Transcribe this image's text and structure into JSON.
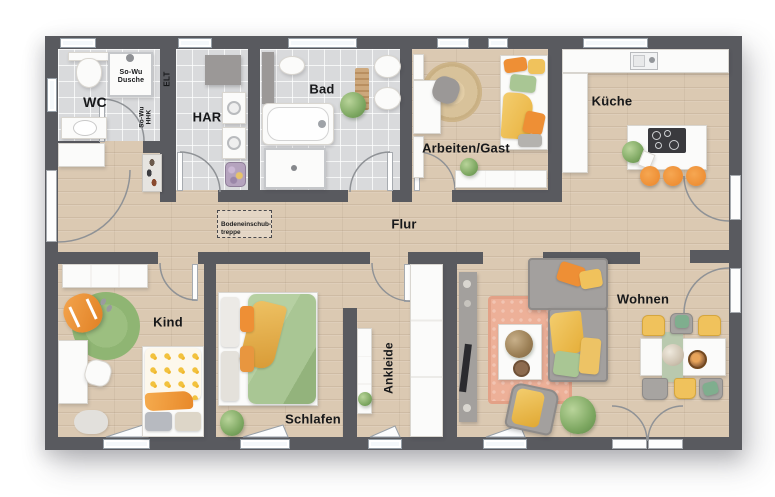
{
  "plan": {
    "type": "floorplan",
    "rooms": {
      "wc": "WC",
      "shower": "So-Wu\nDusche",
      "elt": "ELT",
      "hhk": "So-Wu\nHHK",
      "har": "HAR",
      "bad": "Bad",
      "arbeiten_gast": "Arbeiten/Gast",
      "kueche": "Küche",
      "flur": "Flur",
      "attic_stairs": "Bodeneinschub-\ntreppe",
      "kind": "Kind",
      "schlafen": "Schlafen",
      "ankleide": "Ankleide",
      "wohnen": "Wohnen"
    },
    "colors": {
      "wall": "#595a5f",
      "wood": "#dbc9b2",
      "tile": "#d9dadc",
      "orange": "#ee8f35",
      "yellow": "#f0c25c",
      "green": "#a9c694",
      "rug_green": "#8fb573",
      "salmon": "#edb098",
      "gray": "#9b9897",
      "window_fill": "#f4f8fb",
      "arc": "#8f9296",
      "jute": "#d8c29a"
    }
  }
}
